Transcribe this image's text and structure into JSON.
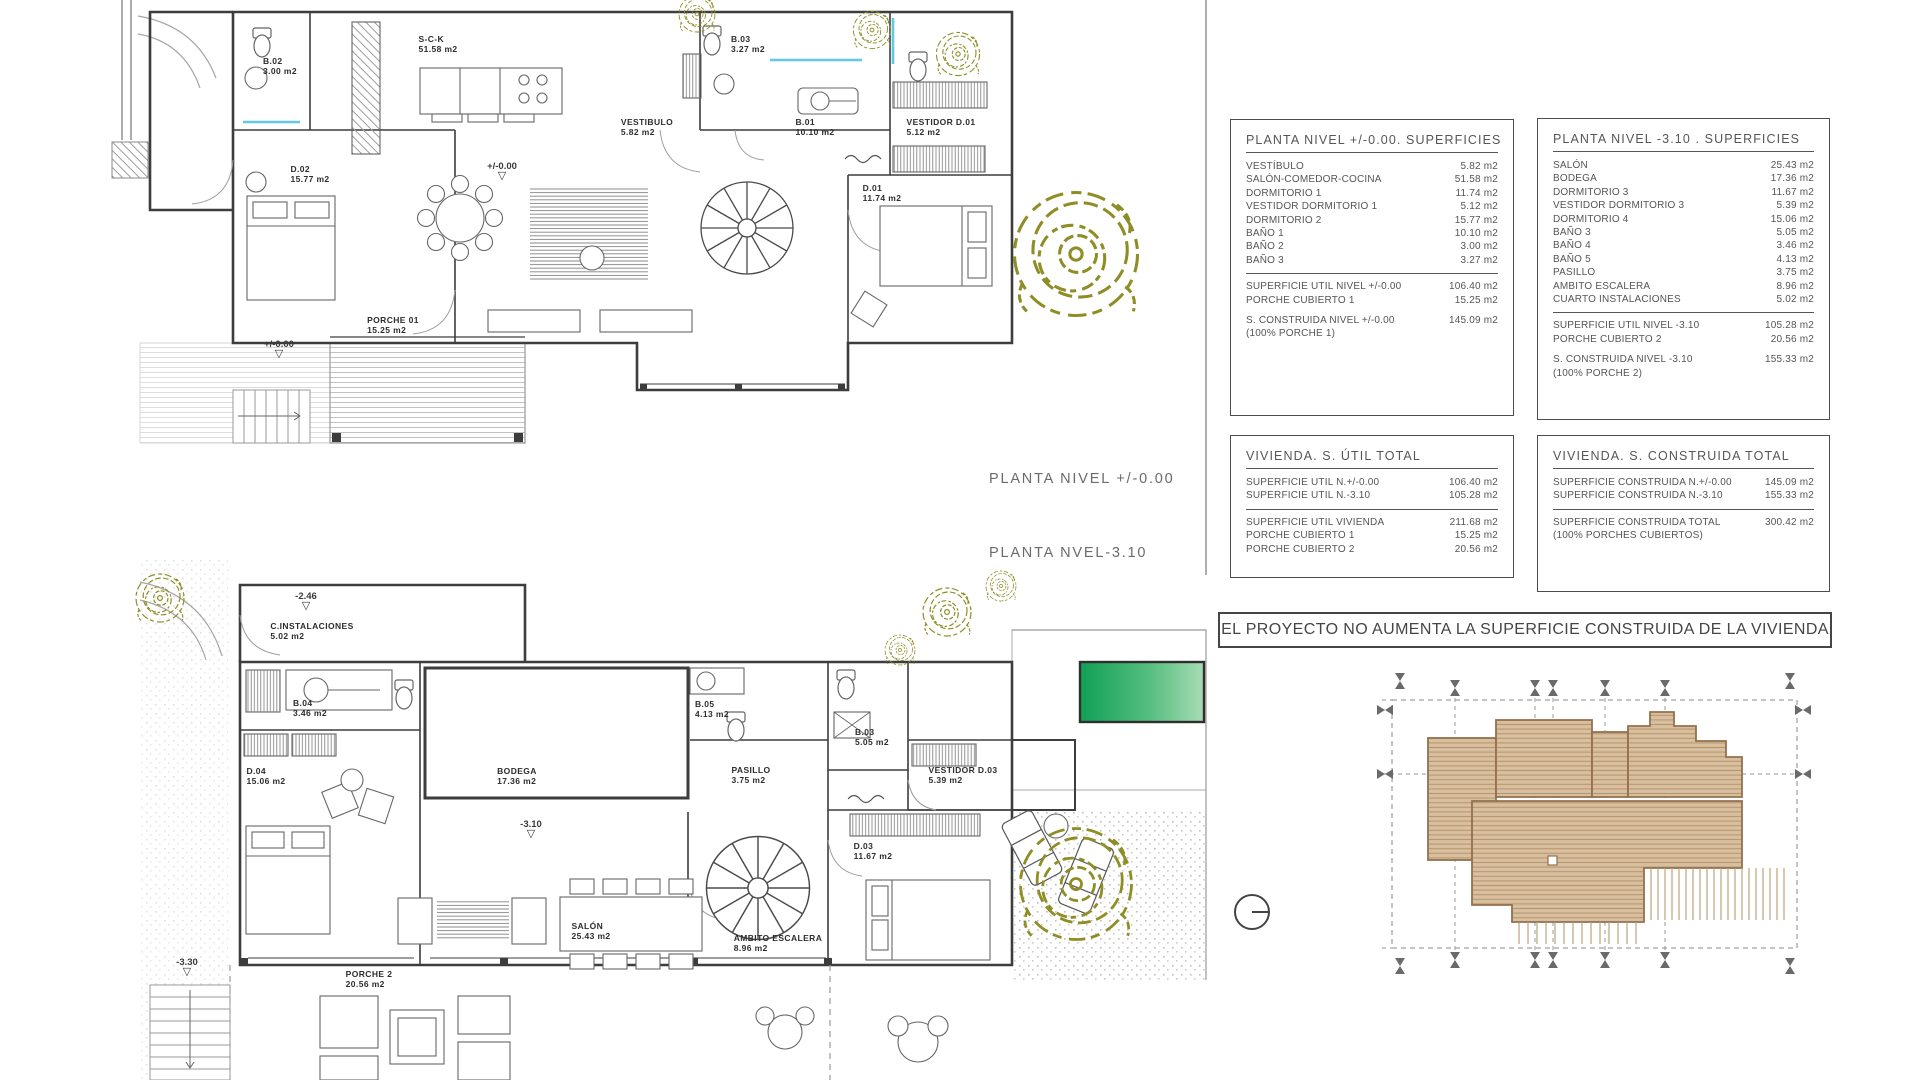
{
  "colors": {
    "line": "#3d3d3d",
    "accent_cyan": "#63c8e6",
    "tree_olive": "#8f8d25",
    "roof_tan": "#d8bf9f",
    "pool_green_dark": "#11a156",
    "pool_green_light": "#a8dcb4"
  },
  "plan_upper": {
    "label": "PLANTA NIVEL +/-0.00",
    "rooms": [
      {
        "name": "B.02",
        "area": "3.00 m2"
      },
      {
        "name": "S-C-K",
        "area": "51.58 m2"
      },
      {
        "name": "B.03",
        "area": "3.27 m2"
      },
      {
        "name": "VESTIBULO",
        "area": "5.82 m2"
      },
      {
        "name": "B.01",
        "area": "10.10 m2"
      },
      {
        "name": "VESTIDOR D.01",
        "area": "5.12 m2"
      },
      {
        "name": "D.02",
        "area": "15.77 m2"
      },
      {
        "name": "D.01",
        "area": "11.74 m2"
      },
      {
        "name": "PORCHE 01",
        "area": "15.25 m2"
      }
    ],
    "level_marks": [
      {
        "value": "+/-0.00"
      },
      {
        "value": "+/-0.00"
      }
    ]
  },
  "plan_lower": {
    "label": "PLANTA NVEL-3.10",
    "rooms": [
      {
        "name": "C.INSTALACIONES",
        "area": "5.02 m2"
      },
      {
        "name": "B.04",
        "area": "3.46 m2"
      },
      {
        "name": "D.04",
        "area": "15.06 m2"
      },
      {
        "name": "BODEGA",
        "area": "17.36 m2"
      },
      {
        "name": "B.05",
        "area": "4.13 m2"
      },
      {
        "name": "B.03",
        "area": "5.05 m2"
      },
      {
        "name": "PASILLO",
        "area": "3.75 m2"
      },
      {
        "name": "VESTIDOR D.03",
        "area": "5.39 m2"
      },
      {
        "name": "D.03",
        "area": "11.67 m2"
      },
      {
        "name": "SALÓN",
        "area": "25.43 m2"
      },
      {
        "name": "AMBITO ESCALERA",
        "area": "8.96 m2"
      },
      {
        "name": "PORCHE 2",
        "area": "20.56 m2"
      }
    ],
    "level_marks": [
      {
        "value": "-2.46"
      },
      {
        "value": "-3.10"
      },
      {
        "value": "-3.30"
      }
    ]
  },
  "tables": {
    "nivel0": {
      "title": "PLANTA NIVEL +/-0.00. SUPERFICIES",
      "rows": [
        {
          "label": "VESTÍBULO",
          "value": "5.82 m2"
        },
        {
          "label": "SALÓN-COMEDOR-COCINA",
          "value": "51.58 m2"
        },
        {
          "label": "DORMITORIO 1",
          "value": "11.74 m2"
        },
        {
          "label": "VESTIDOR DORMITORIO 1",
          "value": "5.12 m2"
        },
        {
          "label": "DORMITORIO 2",
          "value": "15.77 m2"
        },
        {
          "label": "BAÑO 1",
          "value": "10.10 m2"
        },
        {
          "label": "BAÑO 2",
          "value": "3.00 m2"
        },
        {
          "label": "BAÑO 3",
          "value": "3.27 m2"
        },
        {
          "label": "SUPERFICIE UTIL NIVEL +/-0.00",
          "value": "106.40 m2",
          "sep": true
        },
        {
          "label": "PORCHE CUBIERTO 1",
          "value": "15.25 m2"
        },
        {
          "label": "S. CONSTRUIDA NIVEL +/-0.00",
          "value": "145.09 m2",
          "gap": true
        },
        {
          "label": "(100% PORCHE 1)",
          "value": ""
        }
      ]
    },
    "nivel310": {
      "title": "PLANTA NIVEL -3.10 . SUPERFICIES",
      "rows": [
        {
          "label": "SALÓN",
          "value": "25.43 m2"
        },
        {
          "label": "BODEGA",
          "value": "17.36 m2"
        },
        {
          "label": "DORMITORIO 3",
          "value": "11.67 m2"
        },
        {
          "label": "VESTIDOR DORMITORIO 3",
          "value": "5.39 m2"
        },
        {
          "label": "DORMITORIO 4",
          "value": "15.06 m2"
        },
        {
          "label": "BAÑO 3",
          "value": "5.05 m2"
        },
        {
          "label": "BAÑO 4",
          "value": "3.46 m2"
        },
        {
          "label": "BAÑO 5",
          "value": "4.13 m2"
        },
        {
          "label": "PASILLO",
          "value": "3.75 m2"
        },
        {
          "label": "AMBITO ESCALERA",
          "value": "8.96 m2"
        },
        {
          "label": "CUARTO INSTALACIONES",
          "value": "5.02 m2"
        },
        {
          "label": "SUPERFICIE UTIL NIVEL -3.10",
          "value": "105.28 m2",
          "sep": true
        },
        {
          "label": "PORCHE CUBIERTO 2",
          "value": "20.56 m2"
        },
        {
          "label": "S. CONSTRUIDA NIVEL -3.10",
          "value": "155.33 m2",
          "gap": true
        },
        {
          "label": "(100% PORCHE 2)",
          "value": ""
        }
      ]
    },
    "util": {
      "title": "VIVIENDA. S. ÚTIL TOTAL",
      "rows": [
        {
          "label": "SUPERFICIE UTIL N.+/-0.00",
          "value": "106.40 m2"
        },
        {
          "label": "SUPERFICIE UTIL N.-3.10",
          "value": "105.28 m2"
        },
        {
          "label": "SUPERFICIE UTIL VIVIENDA",
          "value": "211.68 m2",
          "sep": true
        },
        {
          "label": "PORCHE CUBIERTO 1",
          "value": "15.25 m2"
        },
        {
          "label": "PORCHE CUBIERTO 2",
          "value": "20.56 m2"
        }
      ]
    },
    "construida": {
      "title": "VIVIENDA. S. CONSTRUIDA TOTAL",
      "rows": [
        {
          "label": "SUPERFICIE CONSTRUIDA N.+/-0.00",
          "value": "145.09 m2"
        },
        {
          "label": "SUPERFICIE CONSTRUIDA N.-3.10",
          "value": "155.33 m2"
        },
        {
          "label": "SUPERFICIE CONSTRUIDA  TOTAL",
          "value": "300.42 m2",
          "sep": true
        },
        {
          "label": "(100% PORCHES CUBIERTOS)",
          "value": ""
        }
      ]
    }
  },
  "banner": {
    "text": "EL PROYECTO NO AUMENTA LA SUPERFICIE CONSTRUIDA DE LA VIVIENDA"
  },
  "markers": {
    "triangle": "▽"
  }
}
